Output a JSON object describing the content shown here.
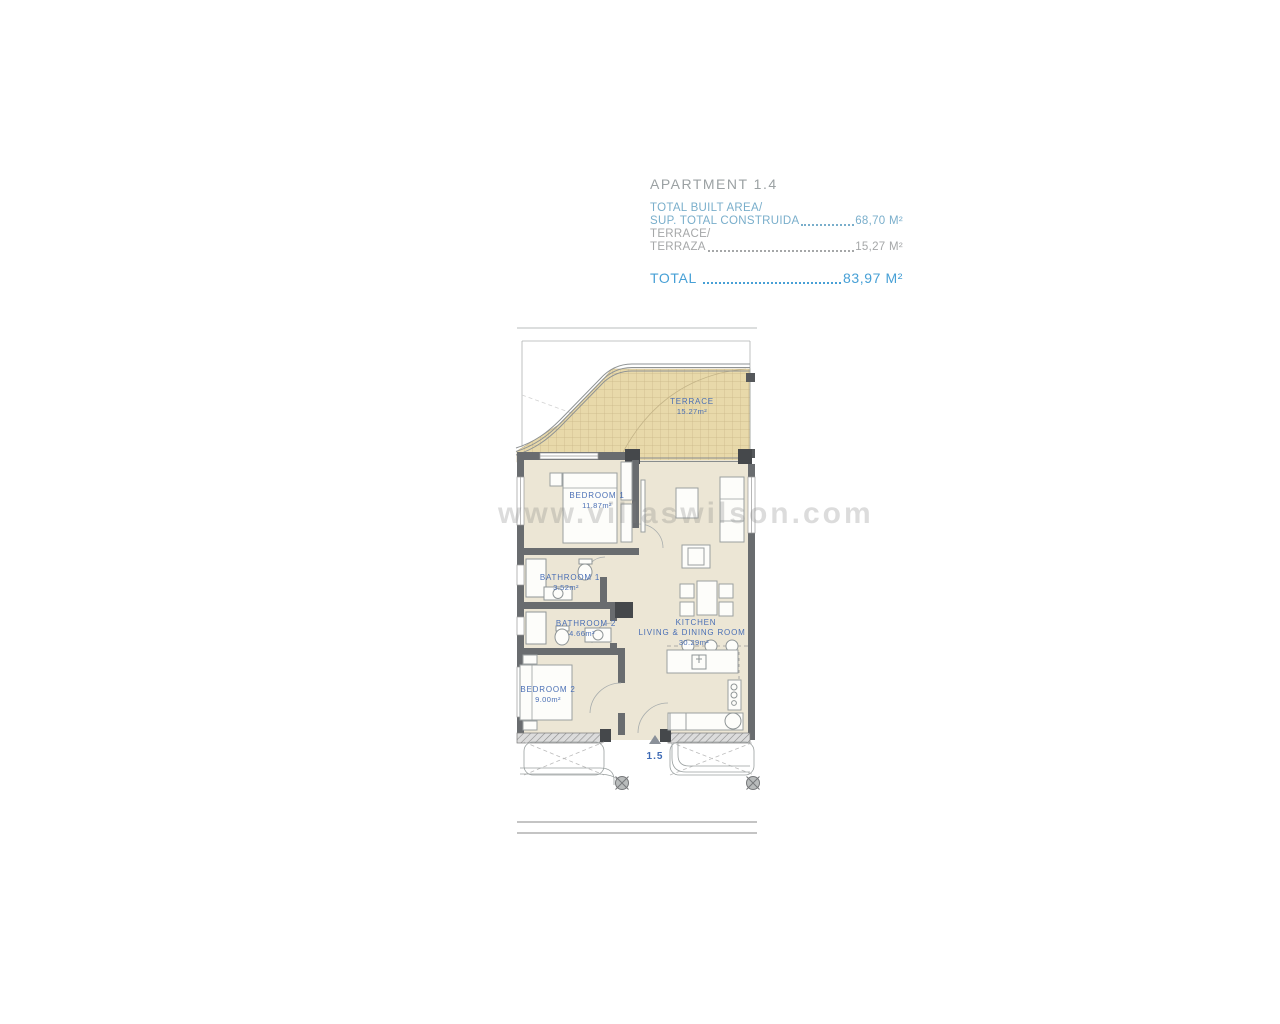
{
  "header": {
    "title": "APARTMENT 1.4",
    "built_label_en": "TOTAL BUILT AREA/",
    "built_label_es": "SUP. TOTAL CONSTRUIDA",
    "built_value": "68,70 M²",
    "terrace_label_en": "TERRACE/",
    "terrace_label_es": "TERRAZA",
    "terrace_value": "15,27 M²",
    "total_label": "TOTAL",
    "total_value": "83,97 M²"
  },
  "floorplan": {
    "terrace": {
      "name": "TERRACE",
      "area": "15.27m²"
    },
    "bedroom1": {
      "name": "BEDROOM 1",
      "area": "11.87m²"
    },
    "bathroom1": {
      "name": "BATHROOM 1",
      "area": "3.52m²"
    },
    "bathroom2": {
      "name": "BATHROOM 2",
      "area": "4.66m²"
    },
    "bedroom2": {
      "name": "BEDROOM 2",
      "area": "9.00m²"
    },
    "kitchen": {
      "name_line1": "KITCHEN",
      "name_line2": "LIVING & DINING ROOM",
      "area": "30.29m²"
    },
    "entry_marker": "1.5"
  },
  "watermark": "www.villaswilson.com",
  "colors": {
    "accent_blue": "#47a0d6",
    "steel_blue": "#79aecb",
    "muted_gray": "#a5a7a8",
    "room_label_blue": "#4a6fb5",
    "floor": "#ece6d5",
    "terrace_fill": "#e8d9aa",
    "terrace_grid": "#c9b687",
    "wall_gray": "#696c6f"
  }
}
